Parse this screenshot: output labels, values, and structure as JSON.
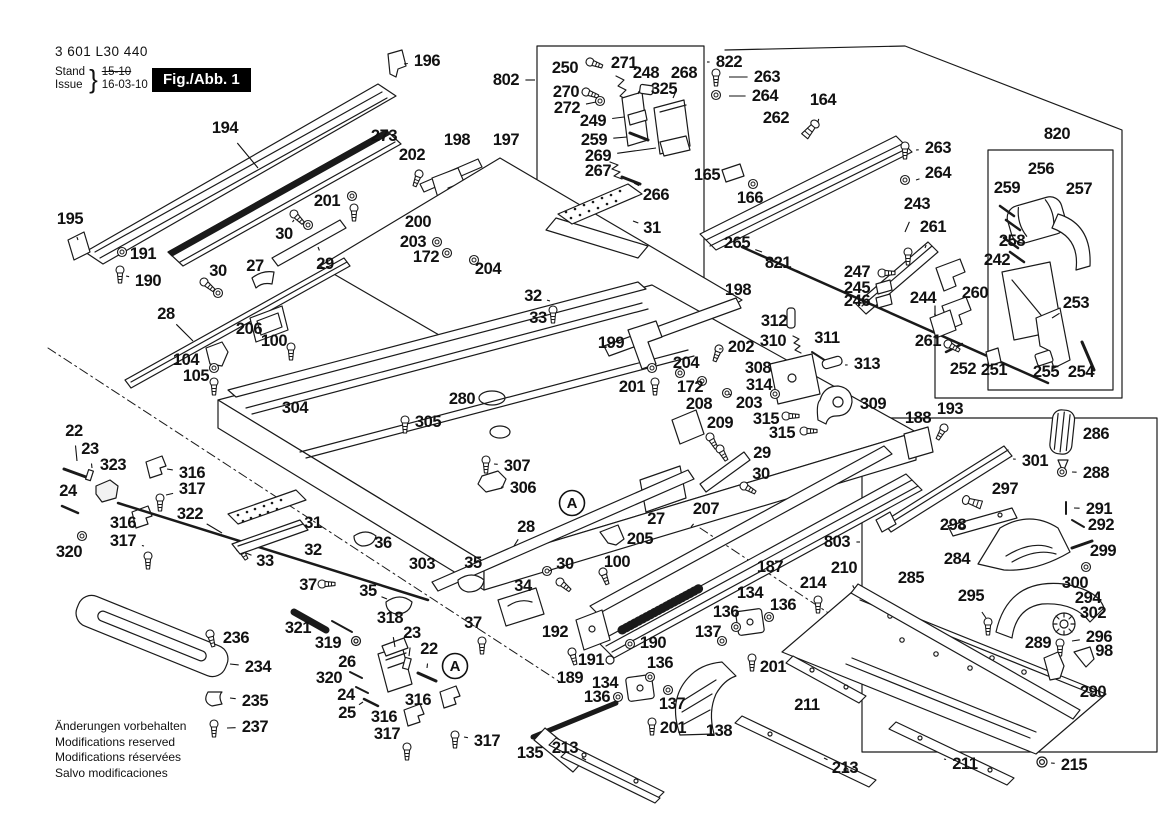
{
  "header": {
    "product_number": "3 601 L30 440",
    "stand_label": "Stand",
    "issue_label": "Issue",
    "brace": "}",
    "date_old": "15-10",
    "date_new": "16-03-10",
    "figure_label": "Fig./Abb. 1"
  },
  "footer": {
    "lines": [
      "Änderungen vorbehalten",
      "Modifications reserved",
      "Modifications réservées",
      "Salvo modificaciones"
    ]
  },
  "colors": {
    "ink": "#1a1a1a",
    "paper": "#ffffff",
    "badge_bg": "#000000",
    "badge_text": "#ffffff"
  },
  "assembly_markers": [
    {
      "label": "A",
      "x": 572,
      "y": 503
    },
    {
      "label": "A",
      "x": 455,
      "y": 666
    }
  ],
  "callouts": [
    {
      "label": "196",
      "x": 427,
      "y": 61,
      "lx": 404,
      "ly": 64
    },
    {
      "label": "194",
      "x": 225,
      "y": 128,
      "lx": 258,
      "ly": 168
    },
    {
      "label": "273",
      "x": 384,
      "y": 136,
      "lx": 366,
      "ly": 140
    },
    {
      "label": "202",
      "x": 412,
      "y": 155,
      "lx": 419,
      "ly": 172
    },
    {
      "label": "198",
      "x": 457,
      "y": 140,
      "lx": 460,
      "ly": 158
    },
    {
      "label": "197",
      "x": 506,
      "y": 140,
      "lx": 500,
      "ly": 157
    },
    {
      "label": "802",
      "x": 506,
      "y": 80,
      "lx": 535,
      "ly": 80
    },
    {
      "label": "250",
      "x": 565,
      "y": 68,
      "lx": 586,
      "ly": 67
    },
    {
      "label": "271",
      "x": 624,
      "y": 63,
      "lx": 621,
      "ly": 76
    },
    {
      "label": "248",
      "x": 646,
      "y": 73,
      "lx": 638,
      "ly": 94
    },
    {
      "label": "268",
      "x": 684,
      "y": 73,
      "lx": 673,
      "ly": 98
    },
    {
      "label": "325",
      "x": 664,
      "y": 89,
      "lx": 650,
      "ly": 90
    },
    {
      "label": "270",
      "x": 566,
      "y": 92,
      "lx": 584,
      "ly": 93
    },
    {
      "label": "272",
      "x": 567,
      "y": 108,
      "lx": 596,
      "ly": 102
    },
    {
      "label": "249",
      "x": 593,
      "y": 121,
      "lx": 624,
      "ly": 117
    },
    {
      "label": "259",
      "x": 594,
      "y": 140,
      "lx": 627,
      "ly": 137
    },
    {
      "label": "269",
      "x": 598,
      "y": 156,
      "lx": 656,
      "ly": 148
    },
    {
      "label": "267",
      "x": 598,
      "y": 171,
      "lx": 616,
      "ly": 168
    },
    {
      "label": "266",
      "x": 656,
      "y": 195,
      "lx": 634,
      "ly": 183
    },
    {
      "label": "822",
      "x": 729,
      "y": 62,
      "lx": 707,
      "ly": 62
    },
    {
      "label": "263",
      "x": 767,
      "y": 77,
      "lx": 729,
      "ly": 77
    },
    {
      "label": "264",
      "x": 765,
      "y": 96,
      "lx": 729,
      "ly": 96
    },
    {
      "label": "164",
      "x": 823,
      "y": 100,
      "lx": 818,
      "ly": 122
    },
    {
      "label": "262",
      "x": 776,
      "y": 118,
      "lx": 772,
      "ly": 136
    },
    {
      "label": "165",
      "x": 707,
      "y": 175,
      "lx": 724,
      "ly": 174
    },
    {
      "label": "166",
      "x": 750,
      "y": 198,
      "lx": 753,
      "ly": 184
    },
    {
      "label": "31",
      "x": 652,
      "y": 228,
      "lx": 633,
      "ly": 221
    },
    {
      "label": "820",
      "x": 1057,
      "y": 134,
      "lx": 1057,
      "ly": 149
    },
    {
      "label": "256",
      "x": 1041,
      "y": 169,
      "lx": 1038,
      "ly": 188
    },
    {
      "label": "259",
      "x": 1007,
      "y": 188,
      "lx": 1008,
      "ly": 204
    },
    {
      "label": "257",
      "x": 1079,
      "y": 189,
      "lx": 1077,
      "ly": 210
    },
    {
      "label": "263",
      "x": 938,
      "y": 148,
      "lx": 916,
      "ly": 150
    },
    {
      "label": "264",
      "x": 938,
      "y": 173,
      "lx": 916,
      "ly": 180
    },
    {
      "label": "243",
      "x": 917,
      "y": 204,
      "lx": 905,
      "ly": 232
    },
    {
      "label": "261",
      "x": 933,
      "y": 227,
      "lx": 925,
      "ly": 248
    },
    {
      "label": "258",
      "x": 1012,
      "y": 241,
      "lx": 1018,
      "ly": 230
    },
    {
      "label": "242",
      "x": 997,
      "y": 260,
      "lx": 1008,
      "ly": 274
    },
    {
      "label": "260",
      "x": 975,
      "y": 293,
      "lx": 958,
      "ly": 288
    },
    {
      "label": "244",
      "x": 923,
      "y": 298,
      "lx": 936,
      "ly": 316
    },
    {
      "label": "261",
      "x": 928,
      "y": 341,
      "lx": 944,
      "ly": 344
    },
    {
      "label": "253",
      "x": 1076,
      "y": 303,
      "lx": 1052,
      "ly": 318
    },
    {
      "label": "252",
      "x": 963,
      "y": 369,
      "lx": 958,
      "ly": 382
    },
    {
      "label": "251",
      "x": 994,
      "y": 370,
      "lx": 992,
      "ly": 383
    },
    {
      "label": "255",
      "x": 1046,
      "y": 372,
      "lx": 1044,
      "ly": 384
    },
    {
      "label": "254",
      "x": 1081,
      "y": 372,
      "lx": 1085,
      "ly": 384
    },
    {
      "label": "265",
      "x": 737,
      "y": 243,
      "lx": 762,
      "ly": 252
    },
    {
      "label": "821",
      "x": 778,
      "y": 263,
      "lx": 800,
      "ly": 272
    },
    {
      "label": "247",
      "x": 857,
      "y": 272,
      "lx": 876,
      "ly": 274
    },
    {
      "label": "245",
      "x": 857,
      "y": 288,
      "lx": 874,
      "ly": 288
    },
    {
      "label": "246",
      "x": 857,
      "y": 301,
      "lx": 874,
      "ly": 300
    },
    {
      "label": "195",
      "x": 70,
      "y": 219,
      "lx": 78,
      "ly": 240
    },
    {
      "label": "191",
      "x": 143,
      "y": 254,
      "lx": 127,
      "ly": 252
    },
    {
      "label": "190",
      "x": 148,
      "y": 281,
      "lx": 126,
      "ly": 276
    },
    {
      "label": "30",
      "x": 284,
      "y": 234,
      "lx": 294,
      "ly": 220
    },
    {
      "label": "201",
      "x": 327,
      "y": 201,
      "lx": 347,
      "ly": 202
    },
    {
      "label": "200",
      "x": 418,
      "y": 222,
      "lx": 434,
      "ly": 224
    },
    {
      "label": "27",
      "x": 255,
      "y": 266,
      "lx": 260,
      "ly": 280
    },
    {
      "label": "29",
      "x": 325,
      "y": 264,
      "lx": 318,
      "ly": 247
    },
    {
      "label": "30",
      "x": 218,
      "y": 271,
      "lx": 207,
      "ly": 281
    },
    {
      "label": "203",
      "x": 413,
      "y": 242,
      "lx": 432,
      "ly": 242
    },
    {
      "label": "172",
      "x": 426,
      "y": 257,
      "lx": 443,
      "ly": 253
    },
    {
      "label": "204",
      "x": 488,
      "y": 269,
      "lx": 477,
      "ly": 261
    },
    {
      "label": "28",
      "x": 166,
      "y": 314,
      "lx": 193,
      "ly": 341
    },
    {
      "label": "206",
      "x": 249,
      "y": 329,
      "lx": 266,
      "ly": 324
    },
    {
      "label": "100",
      "x": 274,
      "y": 341,
      "lx": 288,
      "ly": 345
    },
    {
      "label": "104",
      "x": 186,
      "y": 360,
      "lx": 204,
      "ly": 358
    },
    {
      "label": "105",
      "x": 196,
      "y": 376,
      "lx": 210,
      "ly": 376
    },
    {
      "label": "304",
      "x": 295,
      "y": 408,
      "lx": 302,
      "ly": 393
    },
    {
      "label": "305",
      "x": 428,
      "y": 422,
      "lx": 409,
      "ly": 422
    },
    {
      "label": "280",
      "x": 462,
      "y": 399,
      "lx": 480,
      "ly": 398
    },
    {
      "label": "32",
      "x": 533,
      "y": 296,
      "lx": 550,
      "ly": 301
    },
    {
      "label": "33",
      "x": 538,
      "y": 318,
      "lx": 551,
      "ly": 315
    },
    {
      "label": "199",
      "x": 611,
      "y": 343,
      "lx": 629,
      "ly": 342
    },
    {
      "label": "198",
      "x": 738,
      "y": 290,
      "lx": 724,
      "ly": 304
    },
    {
      "label": "202",
      "x": 741,
      "y": 347,
      "lx": 719,
      "ly": 349
    },
    {
      "label": "201",
      "x": 632,
      "y": 387,
      "lx": 650,
      "ly": 378
    },
    {
      "label": "204",
      "x": 686,
      "y": 363,
      "lx": 681,
      "ly": 372
    },
    {
      "label": "172",
      "x": 690,
      "y": 387,
      "lx": 700,
      "ly": 382
    },
    {
      "label": "203",
      "x": 749,
      "y": 403,
      "lx": 729,
      "ly": 394
    },
    {
      "label": "208",
      "x": 699,
      "y": 404,
      "lx": 690,
      "ly": 418
    },
    {
      "label": "209",
      "x": 720,
      "y": 423,
      "lx": 713,
      "ly": 436
    },
    {
      "label": "312",
      "x": 774,
      "y": 321,
      "lx": 789,
      "ly": 320
    },
    {
      "label": "310",
      "x": 773,
      "y": 341,
      "lx": 791,
      "ly": 342
    },
    {
      "label": "311",
      "x": 827,
      "y": 338,
      "lx": 819,
      "ly": 351
    },
    {
      "label": "308",
      "x": 758,
      "y": 368,
      "lx": 774,
      "ly": 375
    },
    {
      "label": "313",
      "x": 867,
      "y": 364,
      "lx": 845,
      "ly": 365
    },
    {
      "label": "314",
      "x": 759,
      "y": 385,
      "lx": 773,
      "ly": 392
    },
    {
      "label": "309",
      "x": 873,
      "y": 404,
      "lx": 854,
      "ly": 405
    },
    {
      "label": "315",
      "x": 766,
      "y": 419,
      "lx": 783,
      "ly": 418
    },
    {
      "label": "315",
      "x": 782,
      "y": 433,
      "lx": 800,
      "ly": 432
    },
    {
      "label": "188",
      "x": 918,
      "y": 418,
      "lx": 915,
      "ly": 433
    },
    {
      "label": "193",
      "x": 950,
      "y": 409,
      "lx": 944,
      "ly": 425
    },
    {
      "label": "22",
      "x": 74,
      "y": 431,
      "lx": 77,
      "ly": 461
    },
    {
      "label": "23",
      "x": 90,
      "y": 449,
      "lx": 92,
      "ly": 468
    },
    {
      "label": "323",
      "x": 113,
      "y": 465,
      "lx": 110,
      "ly": 482
    },
    {
      "label": "24",
      "x": 68,
      "y": 491,
      "lx": 70,
      "ly": 505
    },
    {
      "label": "316",
      "x": 192,
      "y": 473,
      "lx": 167,
      "ly": 469
    },
    {
      "label": "317",
      "x": 192,
      "y": 489,
      "lx": 166,
      "ly": 495
    },
    {
      "label": "322",
      "x": 190,
      "y": 514,
      "lx": 222,
      "ly": 533
    },
    {
      "label": "316",
      "x": 123,
      "y": 523,
      "lx": 139,
      "ly": 518
    },
    {
      "label": "317",
      "x": 123,
      "y": 541,
      "lx": 144,
      "ly": 546
    },
    {
      "label": "320",
      "x": 69,
      "y": 552,
      "lx": 80,
      "ly": 539
    },
    {
      "label": "31",
      "x": 313,
      "y": 523,
      "lx": 299,
      "ly": 517
    },
    {
      "label": "32",
      "x": 313,
      "y": 550,
      "lx": 301,
      "ly": 546
    },
    {
      "label": "33",
      "x": 265,
      "y": 561,
      "lx": 246,
      "ly": 553
    },
    {
      "label": "307",
      "x": 517,
      "y": 466,
      "lx": 494,
      "ly": 464
    },
    {
      "label": "306",
      "x": 523,
      "y": 488,
      "lx": 501,
      "ly": 487
    },
    {
      "label": "28",
      "x": 526,
      "y": 527,
      "lx": 514,
      "ly": 546
    },
    {
      "label": "205",
      "x": 640,
      "y": 539,
      "lx": 622,
      "ly": 538
    },
    {
      "label": "27",
      "x": 656,
      "y": 519,
      "lx": 659,
      "ly": 505
    },
    {
      "label": "100",
      "x": 617,
      "y": 562,
      "lx": 603,
      "ly": 568
    },
    {
      "label": "30",
      "x": 565,
      "y": 564,
      "lx": 549,
      "ly": 571
    },
    {
      "label": "36",
      "x": 383,
      "y": 543,
      "lx": 372,
      "ly": 541
    },
    {
      "label": "303",
      "x": 422,
      "y": 564,
      "lx": 430,
      "ly": 550
    },
    {
      "label": "35",
      "x": 473,
      "y": 563,
      "lx": 469,
      "ly": 576
    },
    {
      "label": "35",
      "x": 368,
      "y": 591,
      "lx": 387,
      "ly": 599
    },
    {
      "label": "34",
      "x": 523,
      "y": 586,
      "lx": 513,
      "ly": 598
    },
    {
      "label": "29",
      "x": 762,
      "y": 453,
      "lx": 746,
      "ly": 456
    },
    {
      "label": "30",
      "x": 761,
      "y": 474,
      "lx": 748,
      "ly": 482
    },
    {
      "label": "207",
      "x": 706,
      "y": 509,
      "lx": 691,
      "ly": 527
    },
    {
      "label": "187",
      "x": 770,
      "y": 567,
      "lx": 758,
      "ly": 582
    },
    {
      "label": "37",
      "x": 308,
      "y": 585,
      "lx": 320,
      "ly": 584
    },
    {
      "label": "37",
      "x": 473,
      "y": 623,
      "lx": 480,
      "ly": 636
    },
    {
      "label": "318",
      "x": 390,
      "y": 618,
      "lx": 395,
      "ly": 647
    },
    {
      "label": "23",
      "x": 412,
      "y": 633,
      "lx": 409,
      "ly": 656
    },
    {
      "label": "22",
      "x": 429,
      "y": 649,
      "lx": 427,
      "ly": 668
    },
    {
      "label": "321",
      "x": 298,
      "y": 628,
      "lx": 305,
      "ly": 620
    },
    {
      "label": "319",
      "x": 328,
      "y": 643,
      "lx": 338,
      "ly": 631
    },
    {
      "label": "26",
      "x": 347,
      "y": 662,
      "lx": 353,
      "ly": 648
    },
    {
      "label": "320",
      "x": 329,
      "y": 678,
      "lx": 347,
      "ly": 674
    },
    {
      "label": "24",
      "x": 346,
      "y": 695,
      "lx": 356,
      "ly": 689
    },
    {
      "label": "25",
      "x": 347,
      "y": 713,
      "lx": 363,
      "ly": 702
    },
    {
      "label": "316",
      "x": 418,
      "y": 700,
      "lx": 437,
      "ly": 697
    },
    {
      "label": "316",
      "x": 384,
      "y": 717,
      "lx": 401,
      "ly": 714
    },
    {
      "label": "317",
      "x": 387,
      "y": 734,
      "lx": 403,
      "ly": 743
    },
    {
      "label": "317",
      "x": 487,
      "y": 741,
      "lx": 464,
      "ly": 737
    },
    {
      "label": "135",
      "x": 530,
      "y": 753,
      "lx": 547,
      "ly": 750
    },
    {
      "label": "192",
      "x": 555,
      "y": 632,
      "lx": 574,
      "ly": 630
    },
    {
      "label": "190",
      "x": 653,
      "y": 643,
      "lx": 634,
      "ly": 644
    },
    {
      "label": "191",
      "x": 591,
      "y": 660,
      "lx": 606,
      "ly": 660
    },
    {
      "label": "189",
      "x": 570,
      "y": 678,
      "lx": 573,
      "ly": 663
    },
    {
      "label": "134",
      "x": 605,
      "y": 683,
      "lx": 626,
      "ly": 686
    },
    {
      "label": "136",
      "x": 597,
      "y": 697,
      "lx": 615,
      "ly": 697
    },
    {
      "label": "136",
      "x": 660,
      "y": 663,
      "lx": 653,
      "ly": 674
    },
    {
      "label": "137",
      "x": 672,
      "y": 704,
      "lx": 668,
      "ly": 692
    },
    {
      "label": "201",
      "x": 673,
      "y": 728,
      "lx": 655,
      "ly": 724
    },
    {
      "label": "138",
      "x": 719,
      "y": 731,
      "lx": 706,
      "ly": 718
    },
    {
      "label": "134",
      "x": 750,
      "y": 593,
      "lx": 751,
      "ly": 610
    },
    {
      "label": "136",
      "x": 726,
      "y": 612,
      "lx": 734,
      "ly": 624
    },
    {
      "label": "136",
      "x": 783,
      "y": 605,
      "lx": 772,
      "ly": 616
    },
    {
      "label": "137",
      "x": 708,
      "y": 632,
      "lx": 719,
      "ly": 639
    },
    {
      "label": "201",
      "x": 773,
      "y": 667,
      "lx": 757,
      "ly": 661
    },
    {
      "label": "214",
      "x": 813,
      "y": 583,
      "lx": 816,
      "ly": 596
    },
    {
      "label": "210",
      "x": 844,
      "y": 568,
      "lx": 854,
      "ly": 588
    },
    {
      "label": "803",
      "x": 837,
      "y": 542,
      "lx": 860,
      "ly": 542
    },
    {
      "label": "285",
      "x": 911,
      "y": 578,
      "lx": 897,
      "ly": 591
    },
    {
      "label": "295",
      "x": 971,
      "y": 596,
      "lx": 986,
      "ly": 618
    },
    {
      "label": "284",
      "x": 957,
      "y": 559,
      "lx": 976,
      "ly": 556
    },
    {
      "label": "298",
      "x": 953,
      "y": 525,
      "lx": 970,
      "ly": 522
    },
    {
      "label": "297",
      "x": 1005,
      "y": 489,
      "lx": 988,
      "ly": 497
    },
    {
      "label": "301",
      "x": 1035,
      "y": 461,
      "lx": 1013,
      "ly": 459
    },
    {
      "label": "286",
      "x": 1096,
      "y": 434,
      "lx": 1077,
      "ly": 434
    },
    {
      "label": "288",
      "x": 1096,
      "y": 473,
      "lx": 1072,
      "ly": 472
    },
    {
      "label": "291",
      "x": 1099,
      "y": 509,
      "lx": 1074,
      "ly": 508
    },
    {
      "label": "292",
      "x": 1101,
      "y": 525,
      "lx": 1080,
      "ly": 524
    },
    {
      "label": "299",
      "x": 1103,
      "y": 551,
      "lx": 1089,
      "ly": 546
    },
    {
      "label": "300",
      "x": 1075,
      "y": 583,
      "lx": 1084,
      "ly": 570
    },
    {
      "label": "294",
      "x": 1088,
      "y": 598,
      "lx": 1073,
      "ly": 605
    },
    {
      "label": "302",
      "x": 1093,
      "y": 613,
      "lx": 1077,
      "ly": 620
    },
    {
      "label": "296",
      "x": 1099,
      "y": 637,
      "lx": 1072,
      "ly": 641
    },
    {
      "label": "98",
      "x": 1104,
      "y": 651,
      "lx": 1090,
      "ly": 657
    },
    {
      "label": "289",
      "x": 1038,
      "y": 643,
      "lx": 1049,
      "ly": 657
    },
    {
      "label": "290",
      "x": 1093,
      "y": 692,
      "lx": 1080,
      "ly": 679
    },
    {
      "label": "215",
      "x": 1074,
      "y": 765,
      "lx": 1051,
      "ly": 763
    },
    {
      "label": "211",
      "x": 807,
      "y": 705,
      "lx": 817,
      "ly": 694
    },
    {
      "label": "211",
      "x": 965,
      "y": 764,
      "lx": 944,
      "ly": 759
    },
    {
      "label": "213",
      "x": 565,
      "y": 748,
      "lx": 586,
      "ly": 760
    },
    {
      "label": "213",
      "x": 845,
      "y": 768,
      "lx": 824,
      "ly": 758
    },
    {
      "label": "236",
      "x": 236,
      "y": 638,
      "lx": 216,
      "ly": 637
    },
    {
      "label": "234",
      "x": 258,
      "y": 667,
      "lx": 230,
      "ly": 664
    },
    {
      "label": "235",
      "x": 255,
      "y": 701,
      "lx": 230,
      "ly": 698
    },
    {
      "label": "237",
      "x": 255,
      "y": 727,
      "lx": 227,
      "ly": 728
    }
  ]
}
